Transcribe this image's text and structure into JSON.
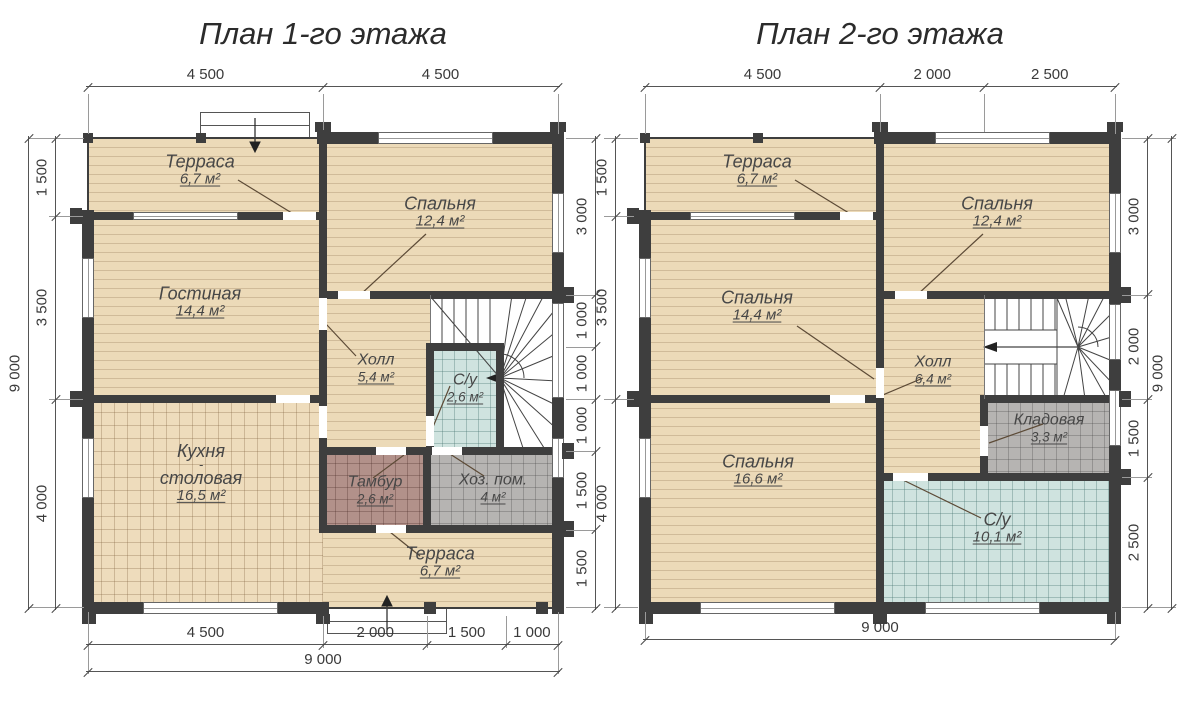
{
  "colors": {
    "wall": "#3e3e3e",
    "wood_floor": "#ecdab8",
    "bath_tile": "#cfe3df",
    "tambour_tile": "#b2918a",
    "utility_tile": "#b6b4b2",
    "dimension_line": "#555555",
    "text": "#474747"
  },
  "plan1": {
    "title": "План 1-го этажа",
    "rooms": {
      "terrace_top": {
        "name": "Терраса",
        "area": "6,7 м²"
      },
      "bedroom": {
        "name": "Спальня",
        "area": "12,4 м²"
      },
      "living": {
        "name": "Гостиная",
        "area": "14,4 м²"
      },
      "hall": {
        "name": "Холл",
        "area": "5,4 м²"
      },
      "wc": {
        "name": "С/у",
        "area": "2,6 м²"
      },
      "kitchen": {
        "name": "Кухня",
        "sep": "-",
        "name2": "столовая",
        "area": "16,5 м²"
      },
      "tambour": {
        "name": "Тамбур",
        "area": "2,6 м²"
      },
      "utility": {
        "name": "Хоз. пом.",
        "area": "4 м²"
      },
      "terrace_bottom": {
        "name": "Терраса",
        "area": "6,7 м²"
      }
    },
    "dims": {
      "top": [
        "4 500",
        "4 500"
      ],
      "left": [
        "1 500",
        "3 500",
        "4 000"
      ],
      "left_total": "9 000",
      "right": [
        "3 000",
        "1 000",
        "1 000",
        "1 000",
        "1 500",
        "1 500"
      ],
      "bottom": [
        "4 500",
        "2 000",
        "1 500",
        "1 000"
      ],
      "bottom_total": "9 000"
    }
  },
  "plan2": {
    "title": "План 2-го этажа",
    "rooms": {
      "terrace": {
        "name": "Терраса",
        "area": "6,7 м²"
      },
      "bedroom1": {
        "name": "Спальня",
        "area": "12,4 м²"
      },
      "bedroom2": {
        "name": "Спальня",
        "area": "14,4 м²"
      },
      "hall": {
        "name": "Холл",
        "area": "6,4 м²"
      },
      "storage": {
        "name": "Кладовая",
        "area": "3,3 м²"
      },
      "bedroom3": {
        "name": "Спальня",
        "area": "16,6 м²"
      },
      "wc": {
        "name": "С/у",
        "area": "10,1 м²"
      }
    },
    "dims": {
      "top": [
        "4 500",
        "2 000",
        "2 500"
      ],
      "left": [
        "1 500",
        "3 500",
        "4 000"
      ],
      "right": [
        "3 000",
        "2 000",
        "1 500",
        "2 500"
      ],
      "right_total": "9 000",
      "bottom_total": "9 000"
    }
  }
}
